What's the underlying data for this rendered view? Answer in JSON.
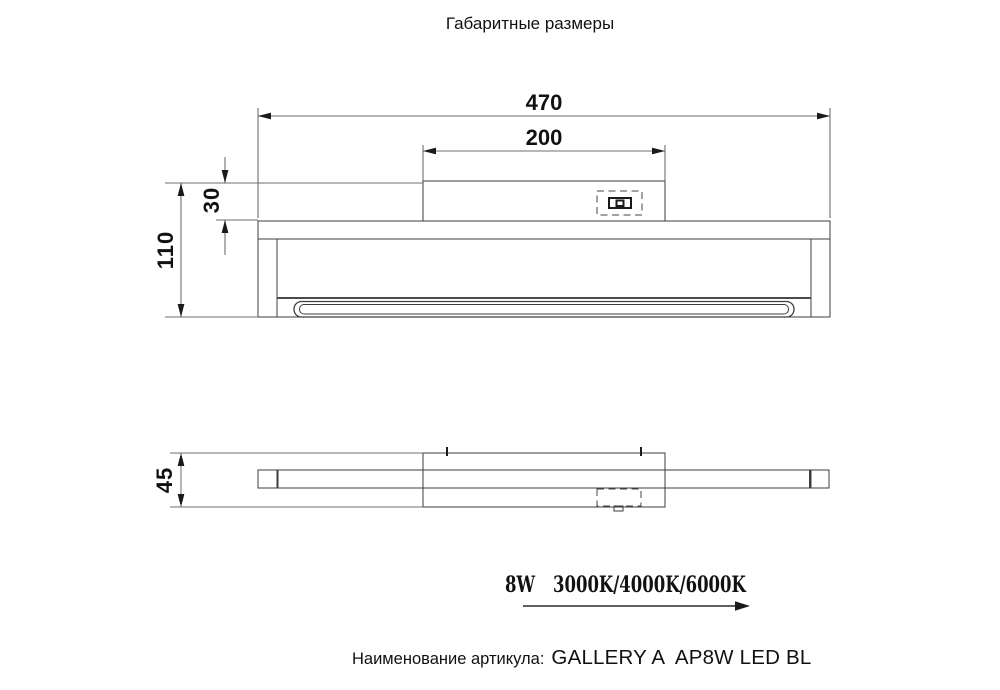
{
  "title": "Габаритные размеры",
  "front_view": {
    "dim_overall_width": "470",
    "dim_plate_width": "200",
    "dim_plate_height": "30",
    "dim_overall_height": "110"
  },
  "top_view": {
    "dim_depth": "45"
  },
  "specs": {
    "power": "8W",
    "color_temps": "3000K/4000K/6000K"
  },
  "caption": {
    "label": "Наименование артикула:",
    "article": "GALLERY A  AP8W LED BL"
  },
  "colors": {
    "line": "#3d3d3d",
    "dim": "#6f6f6f",
    "text": "#111111",
    "bg": "#ffffff"
  }
}
